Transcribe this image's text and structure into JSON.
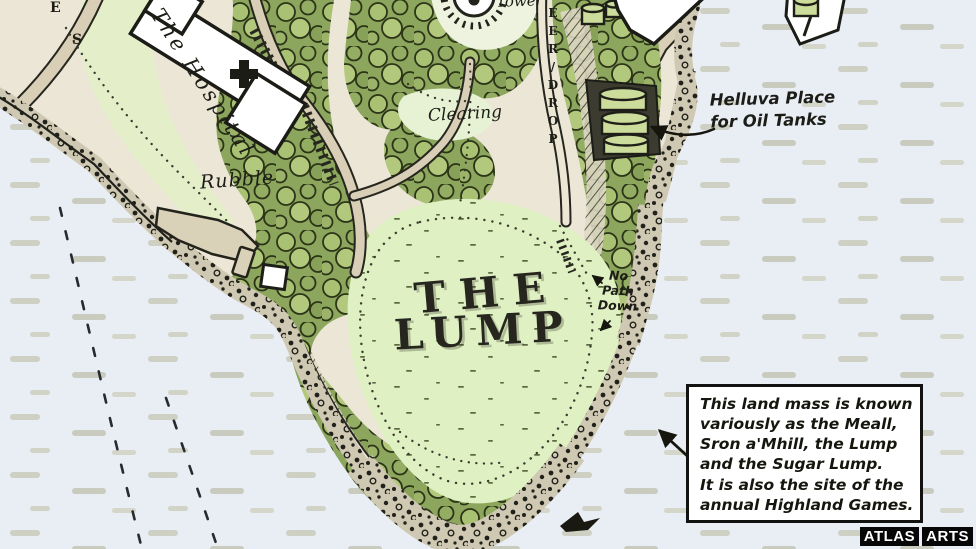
{
  "map": {
    "title_lines": [
      "THE",
      "LUMP"
    ],
    "street_letters": [
      "E",
      "S"
    ],
    "labels": {
      "hospital": "The Hospital",
      "rubble": "Rubble",
      "clearing": "Clearing",
      "tower": "Tower",
      "sheer_drop": "SHEER/DROP",
      "no_path_lines": [
        "No",
        "Path",
        "Down"
      ],
      "oil_tanks_lines": [
        "Helluva Place",
        "for Oil Tanks"
      ]
    },
    "annotation_lines": [
      "This land mass is known",
      "variously as the Meall,",
      "Sron a'Mhill, the Lump",
      "and the Sugar Lump.",
      "It is also the site of the",
      "annual Highland Games."
    ],
    "watermark": {
      "part1": "ATLAS",
      "part2": "ARTS"
    },
    "colors": {
      "water": "#e9edf4",
      "water_dash": "#cdd0c3",
      "ink": "#1d1d17",
      "path_tan": "#d9cfb6",
      "woods_green": "#8ca65d",
      "clearing_green": "#dff0c3",
      "tank_green": "#ccdd9b",
      "building_white": "#ffffff"
    }
  }
}
